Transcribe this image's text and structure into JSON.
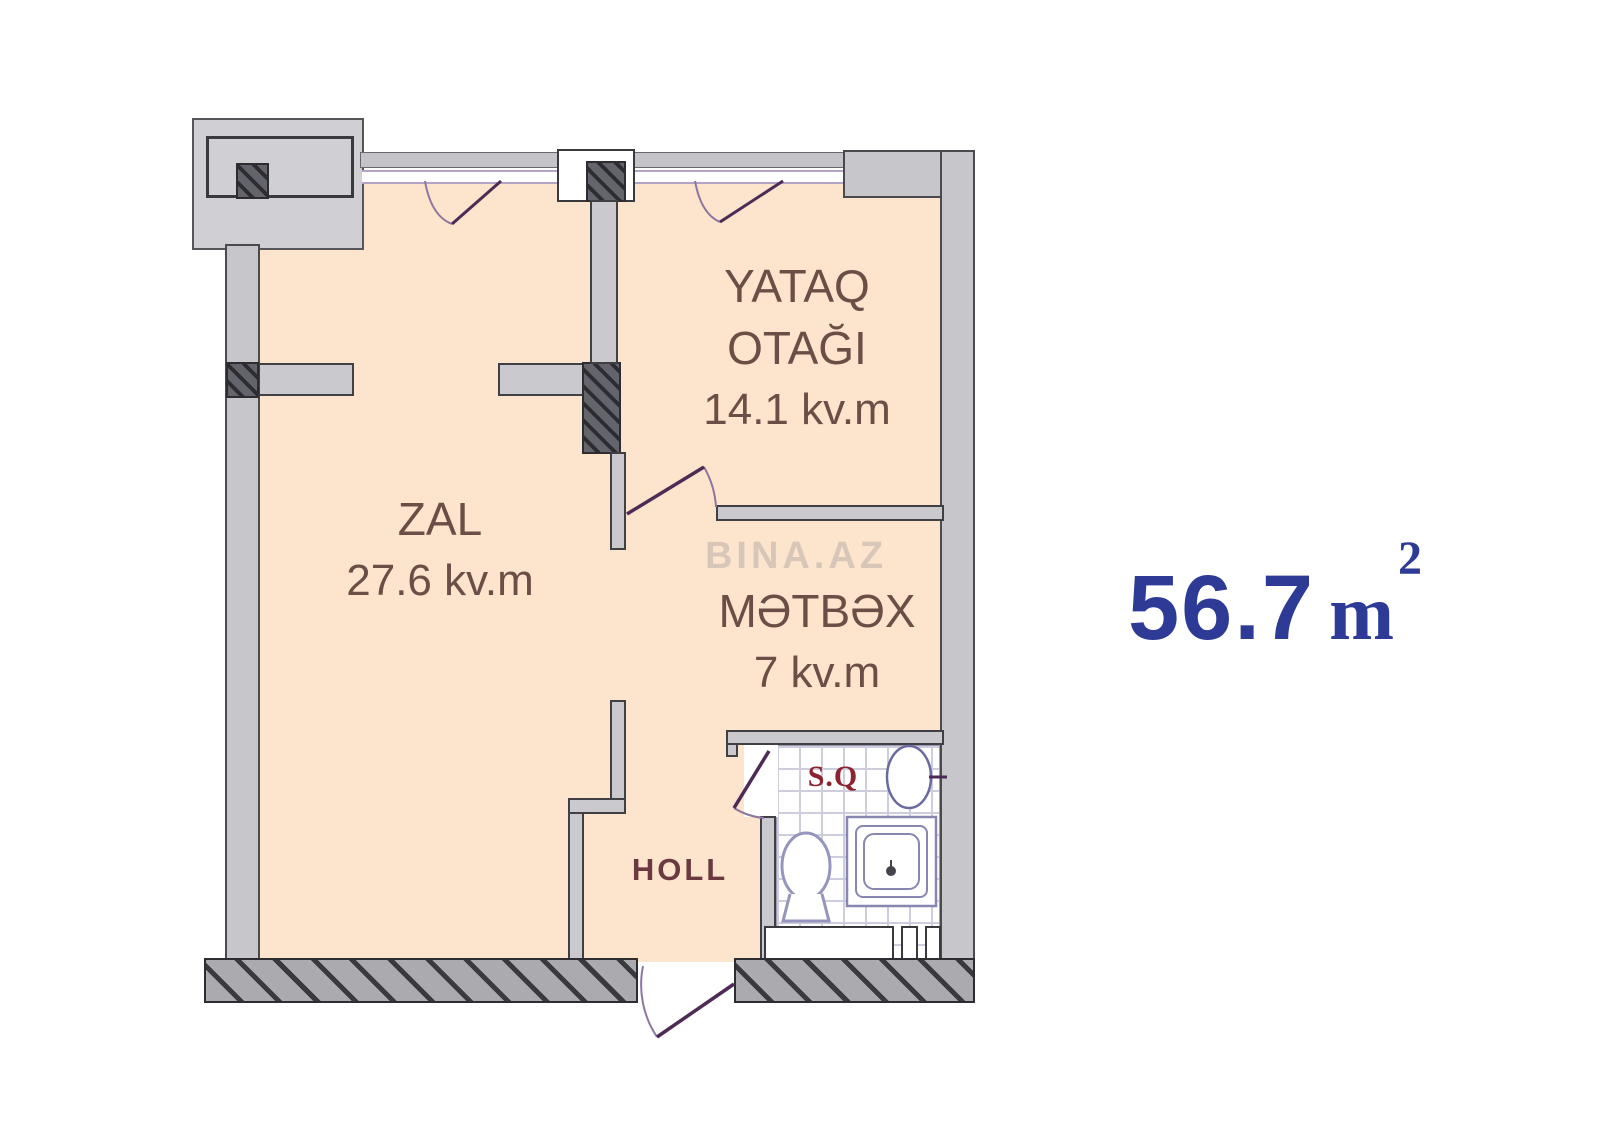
{
  "plan": {
    "rooms": {
      "bedroom": {
        "line1": "YATAQ",
        "line2": "OTAĞI",
        "area": "14.1 kv.m"
      },
      "living": {
        "name": "ZAL",
        "area": "27.6 kv.m"
      },
      "kitchen": {
        "name": "MƏTBƏX",
        "area": "7 kv.m"
      },
      "hall": {
        "name": "HOLL"
      },
      "bathroom": {
        "name": "S.Q"
      }
    },
    "watermark": "BINA.AZ"
  },
  "total_area": {
    "value": "56.7",
    "unit": "m",
    "superscript": "2"
  },
  "colors": {
    "room_fill": "#fce4cd",
    "wall_gray": "#c6c6cb",
    "label_brown": "#6b4e45",
    "hall_maroon": "#6b3a40",
    "bath_red": "#8c2430",
    "door_purple": "#4e2a57",
    "window_purple": "#b4a3c6",
    "total_blue": "#2d3a96"
  }
}
